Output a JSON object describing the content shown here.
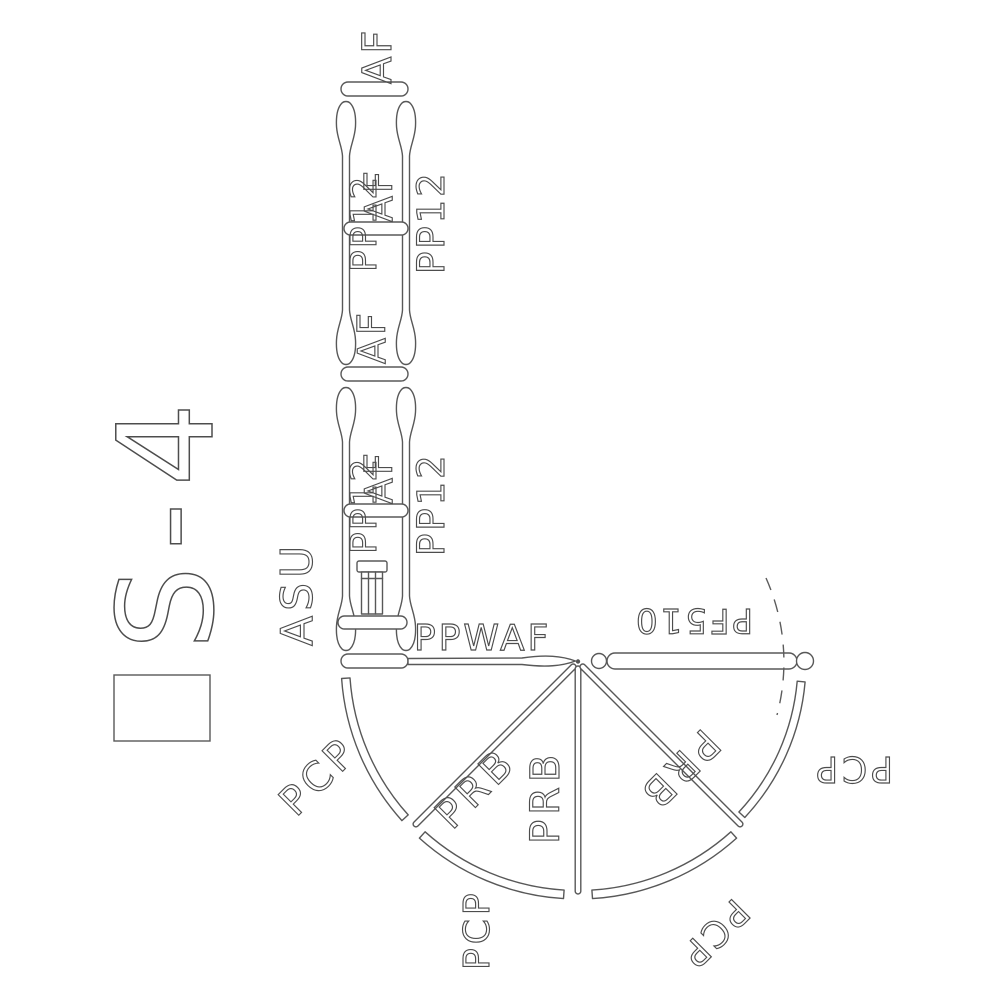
{
  "drawing": {
    "line_color": "#585858",
    "background": "#ffffff",
    "title": {
      "leading_box_glyph": true,
      "text": "S-4"
    },
    "column": {
      "af_top": "AF",
      "segment_a": {
        "pp12_left": "PP12",
        "af_mid": "AF",
        "pp12_right": "PP12"
      },
      "af_joint": "AF",
      "segment_b": {
        "pp12_left": "PP12",
        "af_mid": "AF",
        "pp12_right": "PP12"
      },
      "asu": "ASU",
      "ppwaf": "PPWAF"
    },
    "fan": {
      "pf510": "PF510",
      "prb_left": "PRB",
      "prb_center": "PRB",
      "prb_right": "PRB",
      "pcp_upper_left": "PCP",
      "pcp_lower_left": "PCP",
      "pcp_lower_right": "PCP",
      "pcp_right": "PCP"
    }
  }
}
